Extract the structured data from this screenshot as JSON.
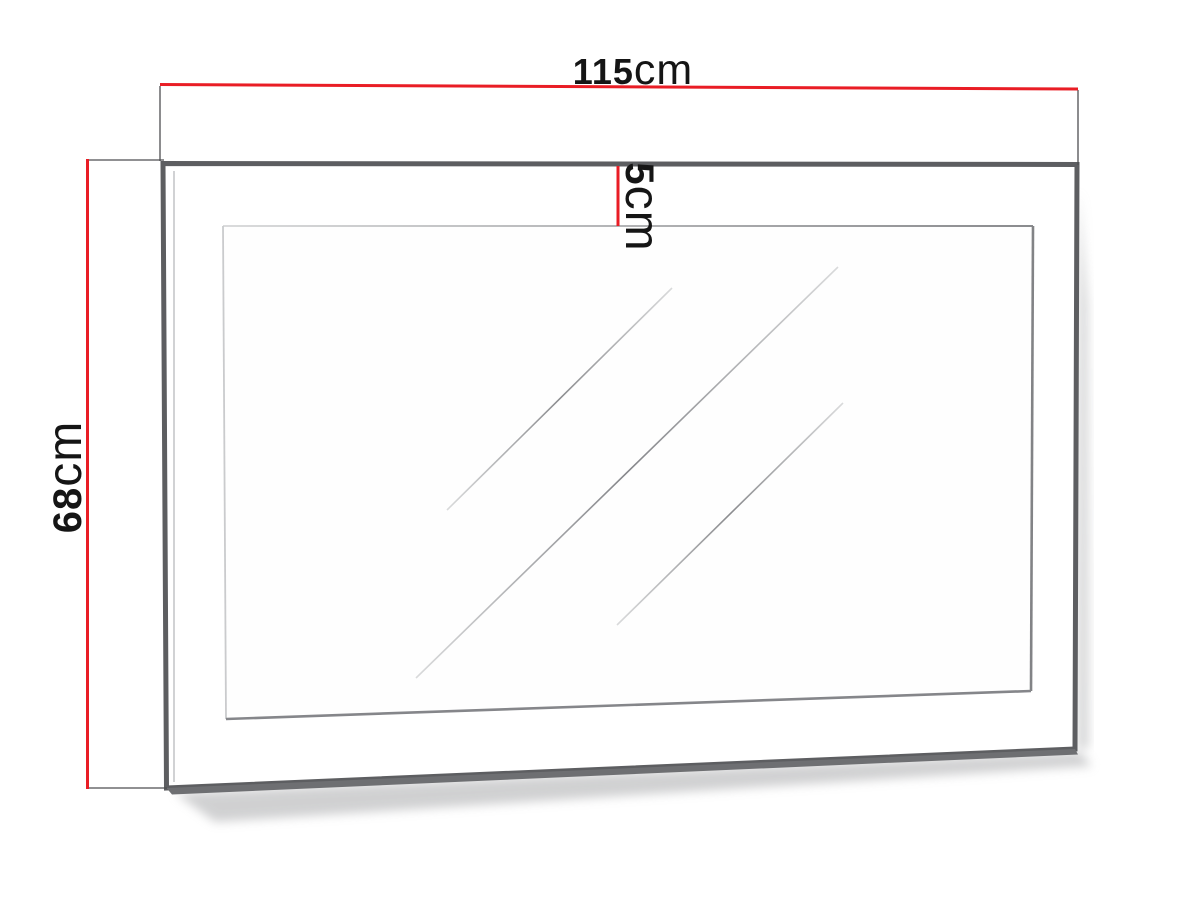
{
  "dimensions": {
    "width": {
      "value": "115",
      "unit": "cm"
    },
    "height": {
      "value": "68",
      "unit": "cm"
    },
    "frame_depth": {
      "value": "5",
      "unit": "cm"
    }
  },
  "colors": {
    "dimension_line": "#e91d25",
    "extension_line": "#4d4e50",
    "frame_outline": "#5d5e61",
    "frame_underside": "#6e6f72",
    "mirror_outline": "#85868a",
    "label_text": "#151515",
    "background": "#ffffff"
  }
}
